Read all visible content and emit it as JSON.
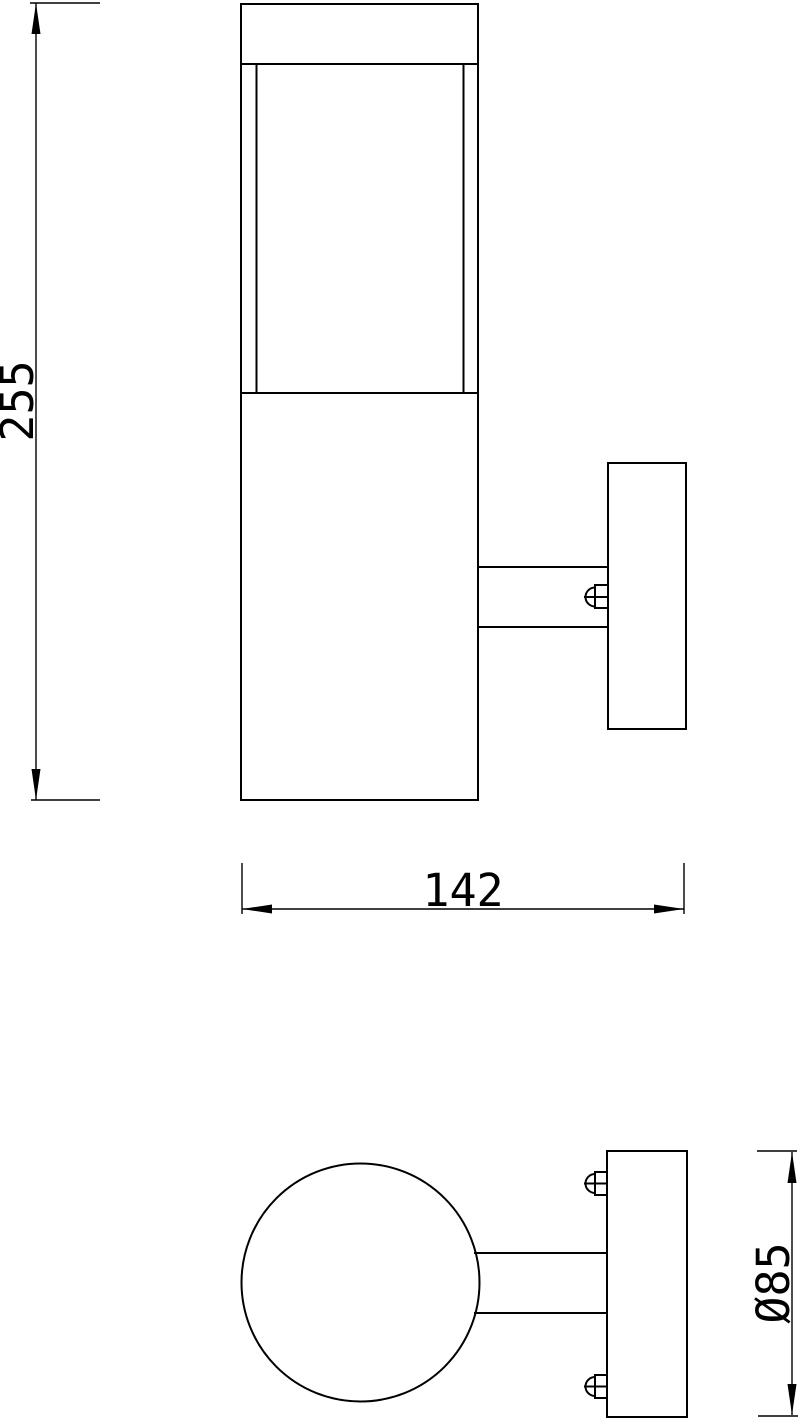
{
  "page": {
    "background": "#ffffff",
    "line_color": "#000000"
  },
  "dimensions": {
    "height_label": "255",
    "width_label": "142",
    "plate_diameter_label": "Ø85"
  },
  "drawing": {
    "viewbox": "0 0 800 1420",
    "shapes": [
      {
        "group": "side",
        "type": "rect",
        "name": "lamp-cap",
        "x": 241,
        "y": 4,
        "w": 237,
        "h": 60
      },
      {
        "group": "side",
        "type": "rect",
        "name": "lamp-body",
        "x": 241,
        "y": 64,
        "w": 237,
        "h": 736
      },
      {
        "group": "side",
        "type": "line",
        "name": "diffuser-inner-edge-left",
        "x1": 256.5,
        "y1": 64,
        "x2": 256.5,
        "y2": 393
      },
      {
        "group": "side",
        "type": "line",
        "name": "diffuser-inner-edge-right",
        "x1": 463.5,
        "y1": 64,
        "x2": 463.5,
        "y2": 393
      },
      {
        "group": "side",
        "type": "line",
        "name": "diffuser-body-junction",
        "x1": 241,
        "y1": 393,
        "x2": 478,
        "y2": 393
      },
      {
        "group": "side",
        "type": "line",
        "name": "mount-arm-top-edge",
        "x1": 478,
        "y1": 567,
        "x2": 608,
        "y2": 567
      },
      {
        "group": "side",
        "type": "line",
        "name": "mount-arm-bottom-edge",
        "x1": 478,
        "y1": 627,
        "x2": 608,
        "y2": 627
      },
      {
        "group": "side",
        "type": "rect",
        "name": "wall-plate-side",
        "x": 608,
        "y": 463,
        "w": 78,
        "h": 266
      },
      {
        "group": "side",
        "type": "rect",
        "name": "arm-screw-body",
        "x": 595,
        "y": 585,
        "w": 13,
        "h": 23
      },
      {
        "group": "side",
        "type": "path",
        "name": "arm-screw-dome",
        "d": "M 595 587.5 A 9.5 9.5 0 0 0 595 606.5"
      },
      {
        "group": "side",
        "type": "line",
        "name": "arm-screw-centerline",
        "x1": 584,
        "y1": 597,
        "x2": 608,
        "y2": 597
      },
      {
        "group": "top",
        "type": "circle",
        "name": "lamp-body-circle",
        "cx": 360.5,
        "cy": 1282.5,
        "r": 119
      },
      {
        "group": "top",
        "type": "line",
        "name": "top-arm-upper-edge",
        "x1": 474,
        "y1": 1253,
        "x2": 607,
        "y2": 1253
      },
      {
        "group": "top",
        "type": "line",
        "name": "top-arm-lower-edge",
        "x1": 474,
        "y1": 1313,
        "x2": 607,
        "y2": 1313
      },
      {
        "group": "top",
        "type": "rect",
        "name": "wall-plate-top",
        "x": 607,
        "y": 1151,
        "w": 80,
        "h": 266
      },
      {
        "group": "top",
        "type": "rect",
        "name": "plate-screw-upper-body",
        "x": 595,
        "y": 1172,
        "w": 12,
        "h": 23
      },
      {
        "group": "top",
        "type": "path",
        "name": "plate-screw-upper-dome",
        "d": "M 595 1174 A 9.5 9.5 0 0 0 595 1193"
      },
      {
        "group": "top",
        "type": "line",
        "name": "plate-screw-upper-centerline",
        "x1": 584,
        "y1": 1183.5,
        "x2": 607,
        "y2": 1183.5
      },
      {
        "group": "top",
        "type": "rect",
        "name": "plate-screw-lower-body",
        "x": 595,
        "y": 1375,
        "w": 12,
        "h": 23
      },
      {
        "group": "top",
        "type": "path",
        "name": "plate-screw-lower-dome",
        "d": "M 595 1377 A 9.5 9.5 0 0 0 595 1396"
      },
      {
        "group": "top",
        "type": "line",
        "name": "plate-screw-lower-centerline",
        "x1": 584,
        "y1": 1386.5,
        "x2": 607,
        "y2": 1386.5
      },
      {
        "group": "dims",
        "type": "line",
        "name": "height-ext-line-top",
        "x1": 30,
        "y1": 3,
        "x2": 100,
        "y2": 3
      },
      {
        "group": "dims",
        "type": "line",
        "name": "height-ext-line-bottom",
        "x1": 31,
        "y1": 800,
        "x2": 100,
        "y2": 800
      },
      {
        "group": "dims",
        "type": "line",
        "name": "height-dim-line",
        "x1": 36,
        "y1": 3,
        "x2": 36,
        "y2": 800
      },
      {
        "group": "dims",
        "type": "polygon",
        "name": "height-arrow-up",
        "points": "36,3 31.5,34 40.5,34"
      },
      {
        "group": "dims",
        "type": "polygon",
        "name": "height-arrow-down",
        "points": "36,800 31.5,769 40.5,769"
      },
      {
        "group": "dims",
        "type": "text",
        "name": "height-dim-text",
        "x": 33,
        "y": 401,
        "rotate": -90,
        "bind": "dimensions.height_label"
      },
      {
        "group": "dims",
        "type": "line",
        "name": "width-ext-line-left",
        "x1": 242,
        "y1": 863,
        "x2": 242,
        "y2": 914
      },
      {
        "group": "dims",
        "type": "line",
        "name": "width-ext-line-right",
        "x1": 684,
        "y1": 863,
        "x2": 684,
        "y2": 914
      },
      {
        "group": "dims",
        "type": "line",
        "name": "width-dim-line",
        "x1": 242,
        "y1": 909,
        "x2": 684,
        "y2": 909
      },
      {
        "group": "dims",
        "type": "polygon",
        "name": "width-arrow-left",
        "points": "242,909 272,904.5 272,913.5"
      },
      {
        "group": "dims",
        "type": "polygon",
        "name": "width-arrow-right",
        "points": "684,909 654,904.5 654,913.5"
      },
      {
        "group": "dims",
        "type": "text",
        "name": "width-dim-text",
        "x": 463,
        "y": 906,
        "bind": "dimensions.width_label"
      },
      {
        "group": "dims",
        "type": "line",
        "name": "diameter-ext-line-top",
        "x1": 757,
        "y1": 1151,
        "x2": 797,
        "y2": 1151
      },
      {
        "group": "dims",
        "type": "line",
        "name": "diameter-ext-line-bottom",
        "x1": 758,
        "y1": 1416,
        "x2": 798,
        "y2": 1416
      },
      {
        "group": "dims",
        "type": "line",
        "name": "diameter-dim-line",
        "x1": 792,
        "y1": 1152,
        "x2": 792,
        "y2": 1415
      },
      {
        "group": "dims",
        "type": "polygon",
        "name": "diameter-arrow-up",
        "points": "792,1152 787.5,1183 796.5,1183"
      },
      {
        "group": "dims",
        "type": "polygon",
        "name": "diameter-arrow-down",
        "points": "792,1415 787.5,1384 796.5,1384"
      },
      {
        "group": "dims",
        "type": "text",
        "name": "diameter-dim-text",
        "x": 789,
        "y": 1283,
        "rotate": -90,
        "bind": "dimensions.plate_diameter_label"
      }
    ]
  }
}
